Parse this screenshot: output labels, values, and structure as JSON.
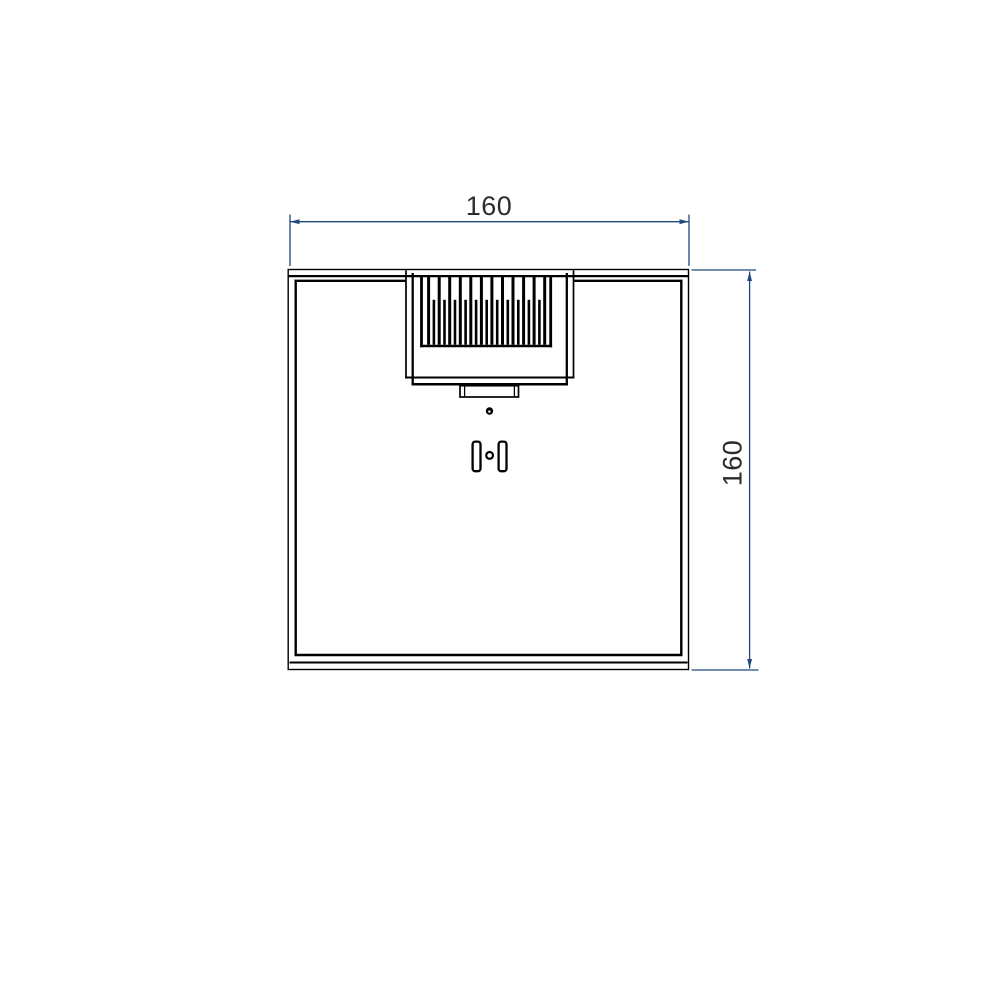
{
  "page": {
    "background_color": "#ffffff",
    "width": 1000,
    "height": 1000
  },
  "drawing": {
    "kind": "cad-dimensioned-top-view",
    "line_color": "#000000",
    "dimension_color": "#1F497D",
    "text_color": "#2b2b2b",
    "dimensions": {
      "top": {
        "label": "160"
      },
      "right": {
        "label": "160"
      }
    },
    "geometry": {
      "groups": [
        {
          "name": "body-outline",
          "color": "#000000",
          "rects": [
            {
              "x": 288.2,
              "y": 269.5,
              "w": 400.3,
              "h": 400.0,
              "sw": 1.4
            }
          ],
          "segments": [
            {
              "x1": 288.5,
              "y1": 276.1,
              "x2": 688.5,
              "y2": 276.1,
              "w": 2.2
            },
            {
              "x1": 295.7,
              "y1": 280.8,
              "x2": 406.0,
              "y2": 280.8,
              "w": 2.4
            },
            {
              "x1": 573.5,
              "y1": 280.8,
              "x2": 681.3,
              "y2": 280.8,
              "w": 2.4
            },
            {
              "x1": 295.7,
              "y1": 279.6,
              "x2": 295.7,
              "y2": 656.0,
              "w": 2.4
            },
            {
              "x1": 681.3,
              "y1": 279.6,
              "x2": 681.3,
              "y2": 656.0,
              "w": 2.4
            },
            {
              "x1": 294.5,
              "y1": 655.0,
              "x2": 682.5,
              "y2": 655.0,
              "w": 2.4
            },
            {
              "x1": 289.5,
              "y1": 662.5,
              "x2": 687.5,
              "y2": 662.5,
              "w": 2.0
            }
          ]
        },
        {
          "name": "fan-housing",
          "color": "#000000",
          "segments": [
            {
              "x1": 406.0,
              "y1": 270.2,
              "x2": 406.0,
              "y2": 378.5,
              "w": 1.7
            },
            {
              "x1": 573.5,
              "y1": 270.2,
              "x2": 573.5,
              "y2": 378.5,
              "w": 1.7
            },
            {
              "x1": 412.7,
              "y1": 273.0,
              "x2": 412.7,
              "y2": 385.0,
              "w": 2.3
            },
            {
              "x1": 566.8,
              "y1": 273.0,
              "x2": 566.8,
              "y2": 385.0,
              "w": 2.3
            },
            {
              "x1": 405.2,
              "y1": 377.5,
              "x2": 574.3,
              "y2": 377.5,
              "w": 2.0
            },
            {
              "x1": 411.6,
              "y1": 384.2,
              "x2": 567.9,
              "y2": 384.2,
              "w": 2.5
            }
          ]
        },
        {
          "name": "heatsink-fin-box",
          "color": "#000000",
          "segments": [
            {
              "x1": 421.5,
              "y1": 276.5,
              "x2": 421.5,
              "y2": 347.3,
              "w": 2.8
            },
            {
              "x1": 550.7,
              "y1": 276.5,
              "x2": 550.7,
              "y2": 347.3,
              "w": 2.8
            },
            {
              "x1": 420.1,
              "y1": 346.0,
              "x2": 552.1,
              "y2": 346.0,
              "w": 2.6
            }
          ]
        },
        {
          "name": "heatsink-fins-long",
          "color": "#000000",
          "segments": [
            {
              "x1": 428.6,
              "y1": 276.5,
              "x2": 428.6,
              "y2": 344.7,
              "w": 3.0
            },
            {
              "x1": 439.2,
              "y1": 276.5,
              "x2": 439.2,
              "y2": 344.7,
              "w": 3.0
            },
            {
              "x1": 449.7,
              "y1": 276.5,
              "x2": 449.7,
              "y2": 344.7,
              "w": 3.0
            },
            {
              "x1": 460.3,
              "y1": 276.5,
              "x2": 460.3,
              "y2": 344.7,
              "w": 3.0
            },
            {
              "x1": 470.8,
              "y1": 276.5,
              "x2": 470.8,
              "y2": 344.7,
              "w": 3.0
            },
            {
              "x1": 481.4,
              "y1": 276.5,
              "x2": 481.4,
              "y2": 344.7,
              "w": 3.0
            },
            {
              "x1": 491.9,
              "y1": 276.5,
              "x2": 491.9,
              "y2": 344.7,
              "w": 3.0
            },
            {
              "x1": 502.5,
              "y1": 276.5,
              "x2": 502.5,
              "y2": 344.7,
              "w": 3.0
            },
            {
              "x1": 513.0,
              "y1": 276.5,
              "x2": 513.0,
              "y2": 344.7,
              "w": 3.0
            },
            {
              "x1": 523.6,
              "y1": 276.5,
              "x2": 523.6,
              "y2": 344.7,
              "w": 3.0
            },
            {
              "x1": 534.1,
              "y1": 276.5,
              "x2": 534.1,
              "y2": 344.7,
              "w": 3.0
            },
            {
              "x1": 544.7,
              "y1": 276.5,
              "x2": 544.7,
              "y2": 344.7,
              "w": 3.0
            }
          ]
        },
        {
          "name": "heatsink-fins-short",
          "color": "#000000",
          "segments": [
            {
              "x1": 433.9,
              "y1": 299.8,
              "x2": 433.9,
              "y2": 344.7,
              "w": 2.6
            },
            {
              "x1": 444.5,
              "y1": 299.8,
              "x2": 444.5,
              "y2": 344.7,
              "w": 2.6
            },
            {
              "x1": 455.0,
              "y1": 299.8,
              "x2": 455.0,
              "y2": 344.7,
              "w": 2.6
            },
            {
              "x1": 465.6,
              "y1": 299.8,
              "x2": 465.6,
              "y2": 344.7,
              "w": 2.6
            },
            {
              "x1": 476.1,
              "y1": 299.8,
              "x2": 476.1,
              "y2": 344.7,
              "w": 2.6
            },
            {
              "x1": 486.7,
              "y1": 299.8,
              "x2": 486.7,
              "y2": 344.7,
              "w": 2.6
            },
            {
              "x1": 497.2,
              "y1": 299.8,
              "x2": 497.2,
              "y2": 344.7,
              "w": 2.6
            },
            {
              "x1": 507.8,
              "y1": 299.8,
              "x2": 507.8,
              "y2": 344.7,
              "w": 2.6
            },
            {
              "x1": 518.3,
              "y1": 299.8,
              "x2": 518.3,
              "y2": 344.7,
              "w": 2.6
            },
            {
              "x1": 528.9,
              "y1": 299.8,
              "x2": 528.9,
              "y2": 344.7,
              "w": 2.6
            },
            {
              "x1": 539.4,
              "y1": 299.8,
              "x2": 539.4,
              "y2": 344.7,
              "w": 2.6
            }
          ]
        },
        {
          "name": "bottom-connector",
          "color": "#000000",
          "rects": [
            {
              "x": 460.0,
              "y": 385.7,
              "w": 58.5,
              "h": 11.3,
              "sw": 1.7
            }
          ],
          "segments": [
            {
              "x1": 464.6,
              "y1": 386.2,
              "x2": 464.6,
              "y2": 396.6,
              "w": 1.3
            },
            {
              "x1": 514.4,
              "y1": 386.2,
              "x2": 514.4,
              "y2": 396.6,
              "w": 1.3
            }
          ]
        },
        {
          "name": "screw-head",
          "color": "#000000",
          "circles": [
            {
              "cx": 489.5,
              "cy": 411.0,
              "r": 3.7,
              "fill": "#000000"
            },
            {
              "cx": 489.4,
              "cy": 411.6,
              "r": 1.2,
              "fill": "#ffffff"
            }
          ]
        },
        {
          "name": "mounting-slots",
          "color": "#000000",
          "rects": [
            {
              "x": 472.6,
              "y": 441.6,
              "w": 7.9,
              "h": 29.6,
              "rx": 2.6,
              "sw": 2.3,
              "fill": "#ffffff"
            },
            {
              "x": 498.6,
              "y": 441.6,
              "w": 7.9,
              "h": 29.6,
              "rx": 2.6,
              "sw": 2.3,
              "fill": "#ffffff"
            }
          ],
          "circles": [
            {
              "cx": 489.6,
              "cy": 455.4,
              "r": 3.4,
              "sw": 2.2,
              "fill": "#ffffff"
            }
          ]
        },
        {
          "name": "dimension-top",
          "color": "#1F497D",
          "segments": [
            {
              "x1": 290.0,
              "y1": 214.5,
              "x2": 290.0,
              "y2": 266.0,
              "w": 1.3
            },
            {
              "x1": 689.0,
              "y1": 214.5,
              "x2": 689.0,
              "y2": 266.0,
              "w": 1.3
            },
            {
              "x1": 290.0,
              "y1": 221.7,
              "x2": 689.0,
              "y2": 221.7,
              "w": 1.3
            }
          ],
          "polygons": [
            [
              [
                290.0,
                221.7
              ],
              [
                299.5,
                219.3
              ],
              [
                299.5,
                224.1
              ]
            ],
            [
              [
                689.0,
                221.7
              ],
              [
                679.5,
                219.3
              ],
              [
                679.5,
                224.1
              ]
            ]
          ]
        },
        {
          "name": "dimension-right",
          "color": "#1F497D",
          "segments": [
            {
              "x1": 691.5,
              "y1": 270.0,
              "x2": 756.0,
              "y2": 270.0,
              "w": 1.3
            },
            {
              "x1": 691.5,
              "y1": 670.0,
              "x2": 758.5,
              "y2": 670.0,
              "w": 1.3
            },
            {
              "x1": 749.6,
              "y1": 271.5,
              "x2": 749.6,
              "y2": 668.5,
              "w": 1.3
            }
          ],
          "polygons": [
            [
              [
                749.6,
                271.5
              ],
              [
                747.2,
                281.0
              ],
              [
                752.0,
                281.0
              ]
            ],
            [
              [
                749.6,
                668.5
              ],
              [
                747.2,
                659.0
              ],
              [
                752.0,
                659.0
              ]
            ]
          ]
        }
      ]
    }
  }
}
